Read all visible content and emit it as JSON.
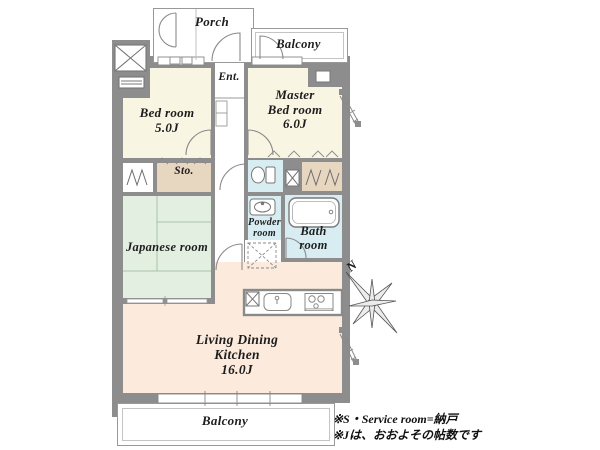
{
  "rooms": {
    "porch": {
      "label": "Porch"
    },
    "balcony_top": {
      "label": "Balcony"
    },
    "entrance": {
      "label": "Ent."
    },
    "bedroom": {
      "line1": "Bed room",
      "line2": "5.0J"
    },
    "master_bedroom": {
      "line1": "Master",
      "line2": "Bed room",
      "line3": "6.0J"
    },
    "storage": {
      "label": "Sto."
    },
    "japanese_room": {
      "label": "Japanese room"
    },
    "powder_room": {
      "line1": "Powder",
      "line2": "room"
    },
    "bath_room": {
      "line1": "Bath",
      "line2": "room"
    },
    "ldk": {
      "line1": "Living Dining",
      "line2": "Kitchen",
      "line3": "16.0J"
    },
    "balcony_bottom": {
      "label": "Balcony"
    }
  },
  "compass": {
    "north_label": "N"
  },
  "notes": {
    "line1": "※S・Service room=納戸",
    "line2": "※Jは、おおよその帖数です"
  },
  "colors": {
    "wall_gray": "#8d8d8d",
    "room_cream": "#f8f5e3",
    "tatami_green": "#e2efe1",
    "ldk_peach": "#fcebdc",
    "wet_area_blue": "#d8edf2",
    "closet_tan": "#e8d7c0",
    "outline_gray": "#999999",
    "text": "#1d1d1d"
  }
}
